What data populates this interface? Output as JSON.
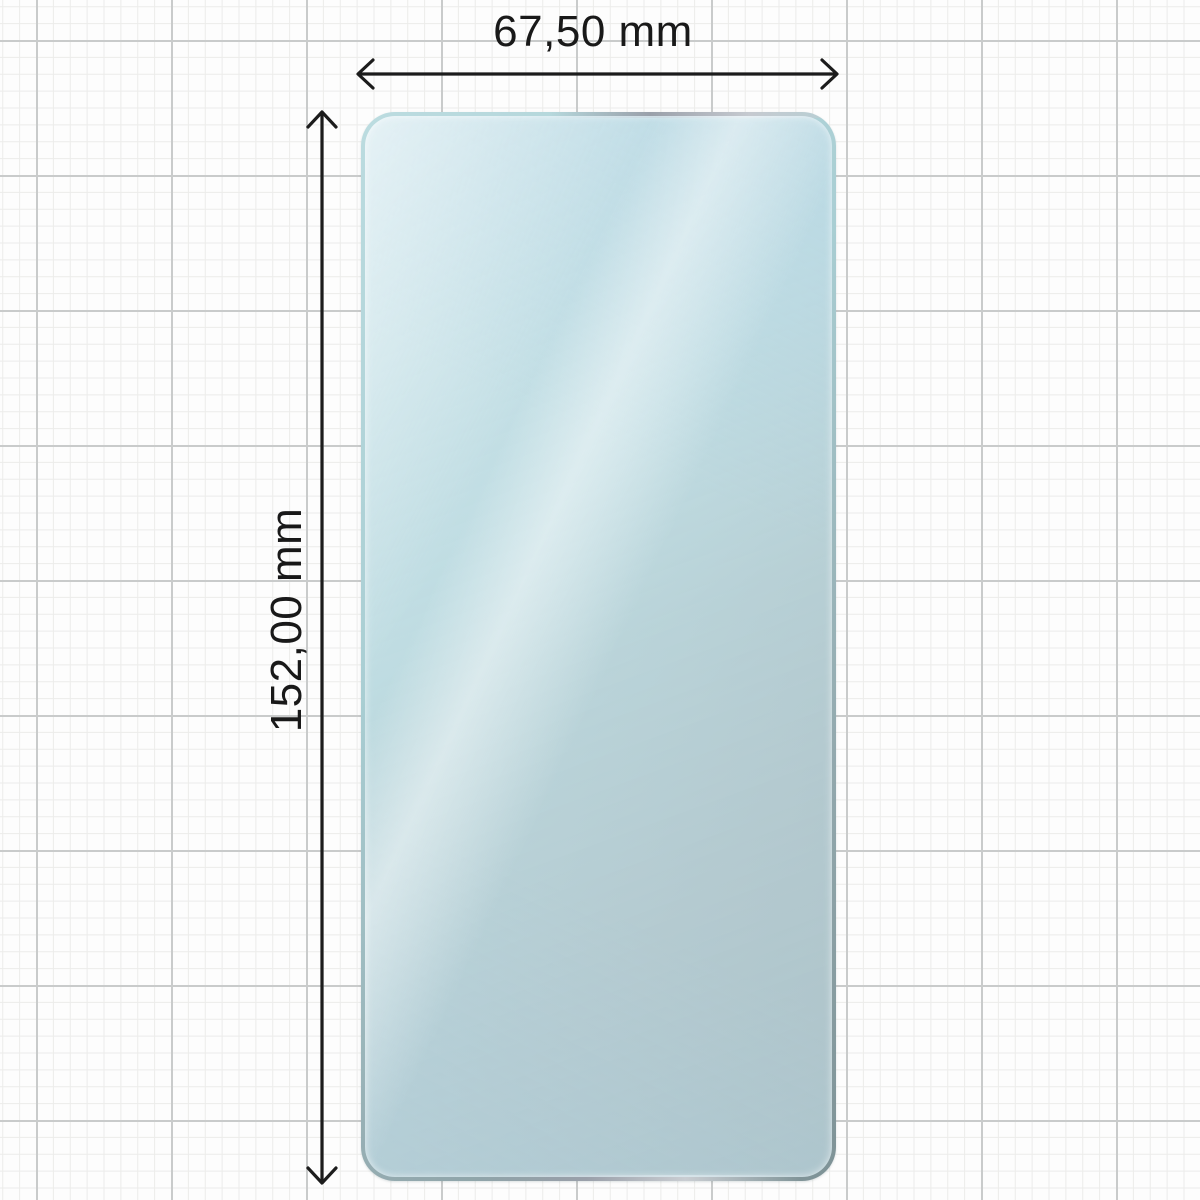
{
  "diagram": {
    "width_label": "67,50 mm",
    "height_label": "152,00 mm",
    "unit": "mm"
  },
  "colors": {
    "arrow": "#1c1c1c",
    "label_text": "#191919",
    "film_surface_tint": "#e7f2f7",
    "film_edge_light_teal": "#b5d8dc",
    "film_edge_dark_teal": "#7e9296",
    "film_edge_silver": "#c6cad0",
    "grid_minor_line": "#ececea",
    "grid_major_line": "#c9cbcb",
    "paper_background": "#fdfdfd"
  }
}
